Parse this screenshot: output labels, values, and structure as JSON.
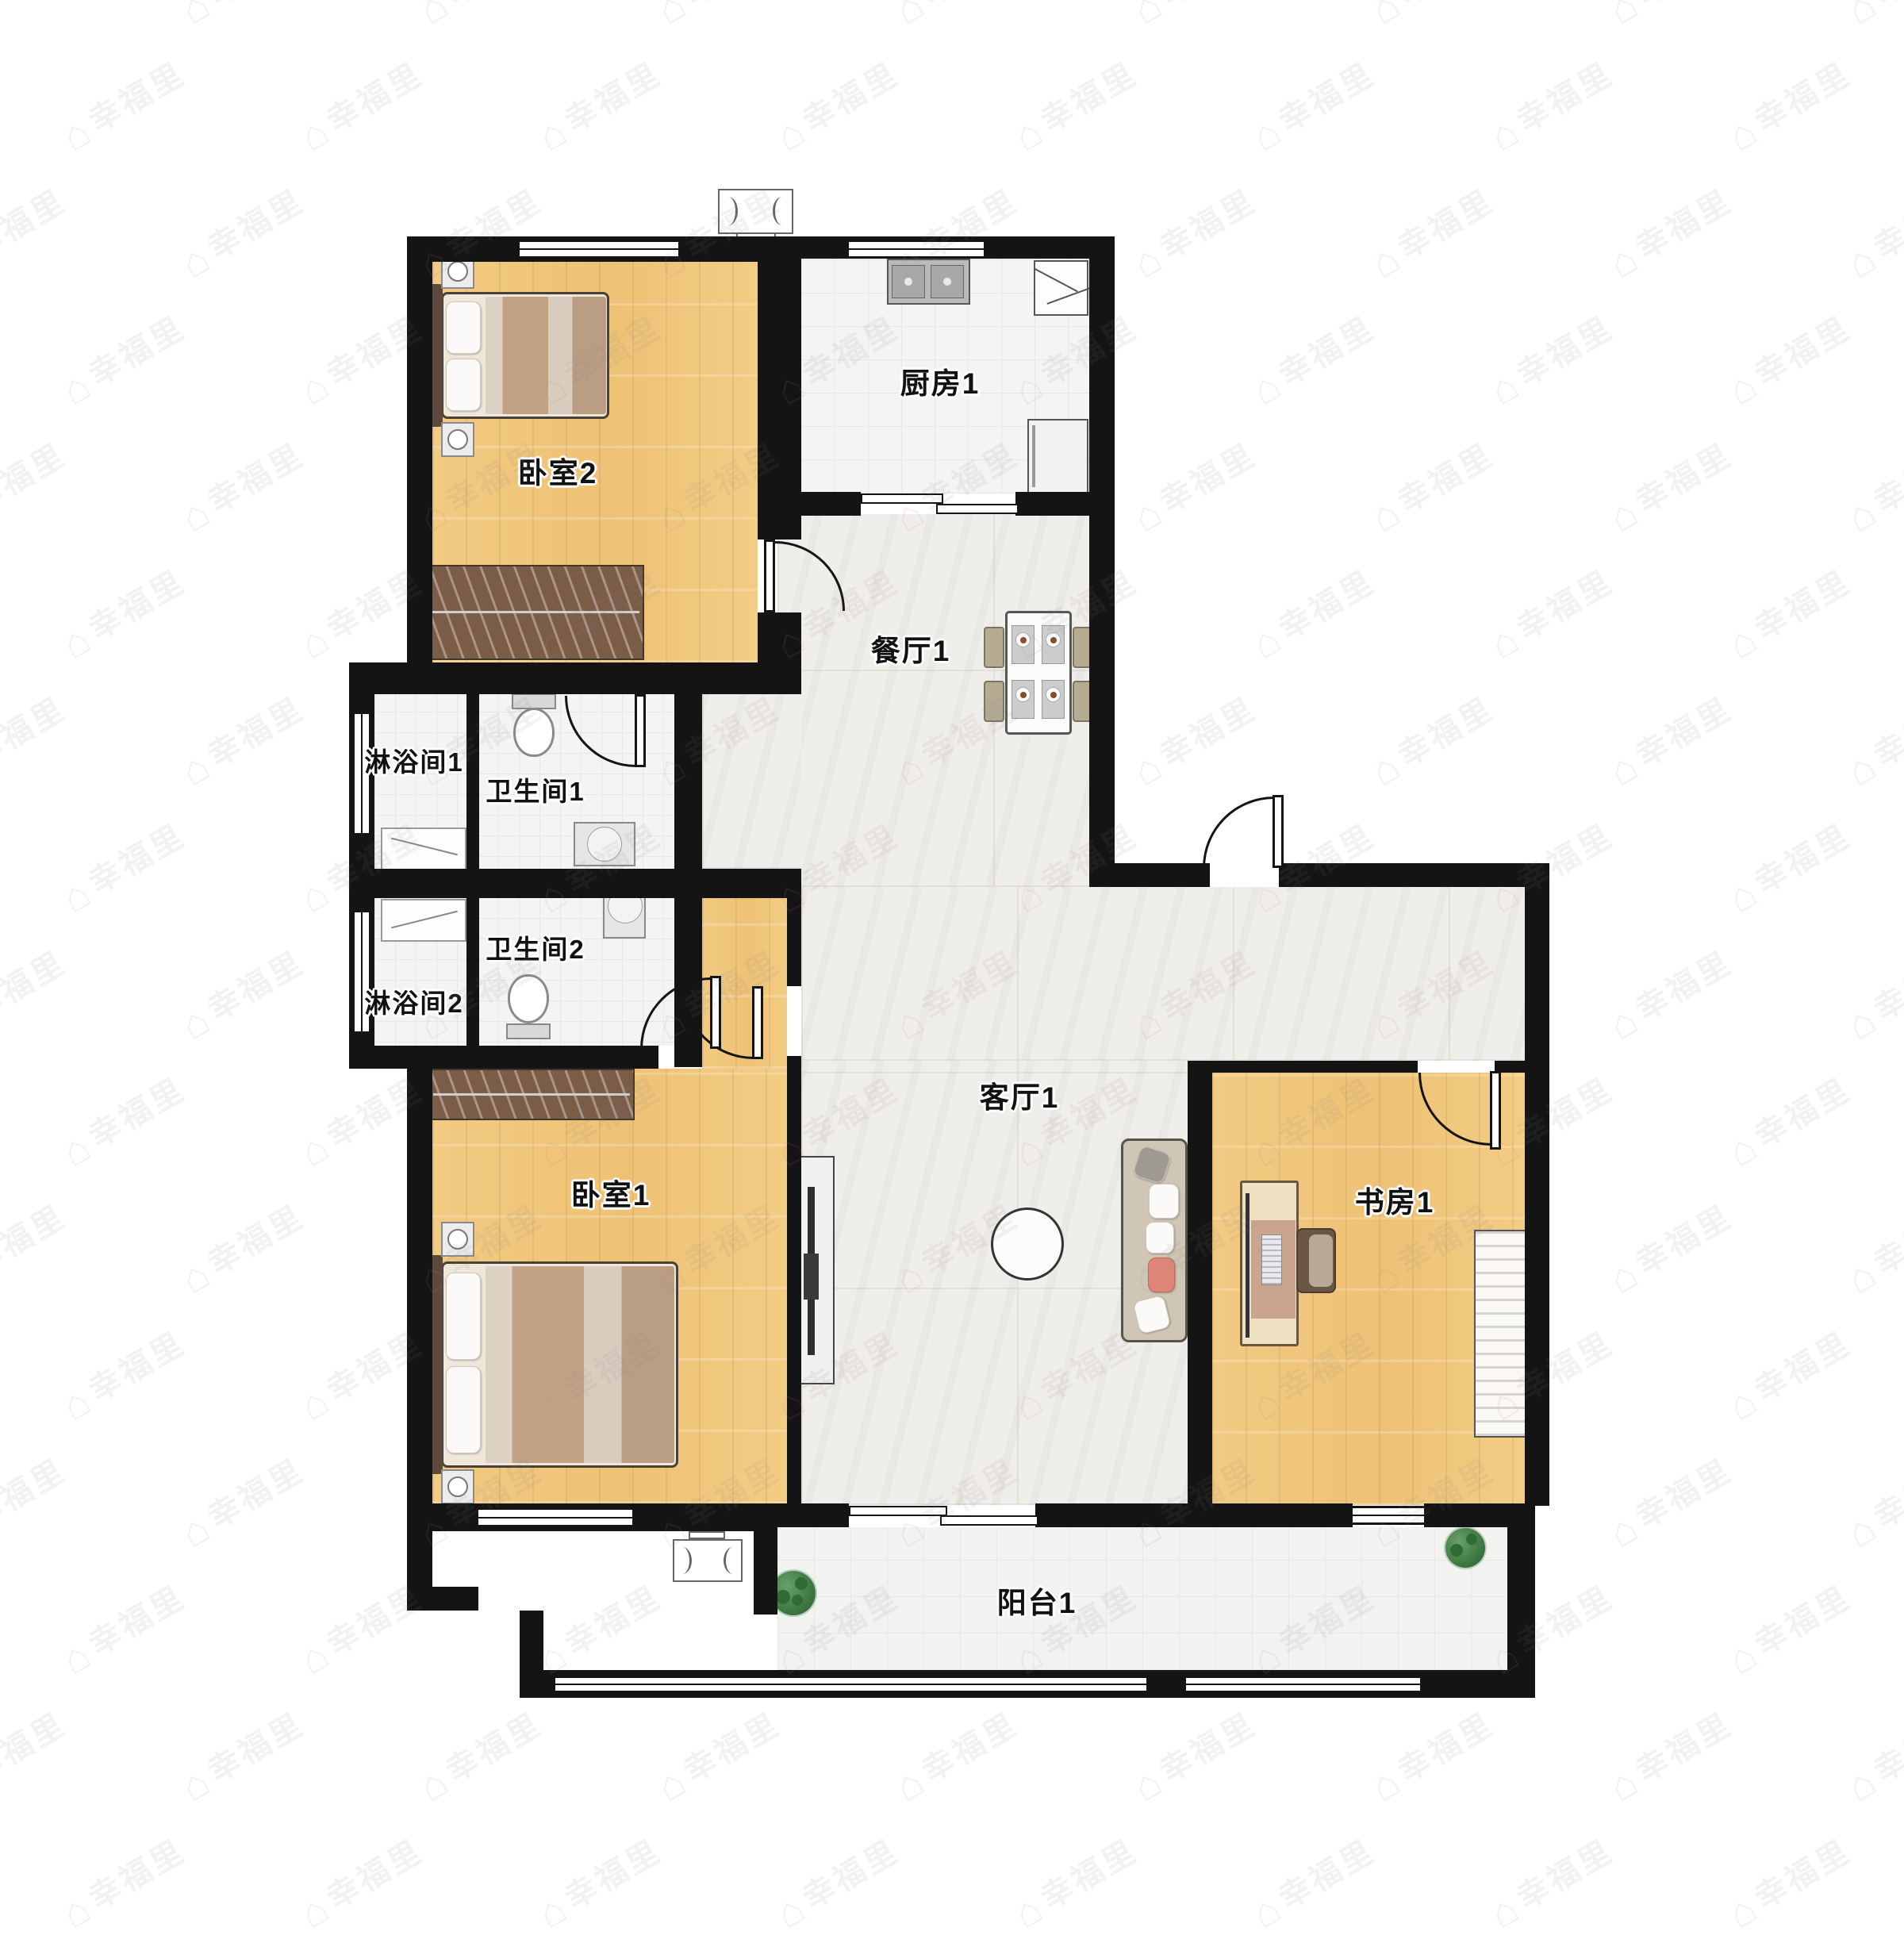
{
  "plan": {
    "type": "apartment-floor-plan",
    "rooms": {
      "bedroom2": {
        "label": "卧室2"
      },
      "kitchen": {
        "label": "厨房1"
      },
      "dining": {
        "label": "餐厅1"
      },
      "shower1": {
        "label": "淋浴间1"
      },
      "bath1": {
        "label": "卫生间1"
      },
      "bath2": {
        "label": "卫生间2"
      },
      "shower2": {
        "label": "淋浴间2"
      },
      "bedroom1": {
        "label": "卧室1"
      },
      "living": {
        "label": "客厅1"
      },
      "study": {
        "label": "书房1"
      },
      "balcony": {
        "label": "阳台1"
      }
    },
    "colors": {
      "wall": "#141414",
      "wood_floor": "#f1c87e",
      "tile_floor": "#f4f4f3",
      "marble_floor": "#f0eeeb",
      "wardrobe": "#7b5c47",
      "sofa": "#cfc6b6",
      "accent_pillow": "#dd8677"
    }
  },
  "watermark": {
    "text": "幸福里",
    "icon": "house-icon"
  }
}
